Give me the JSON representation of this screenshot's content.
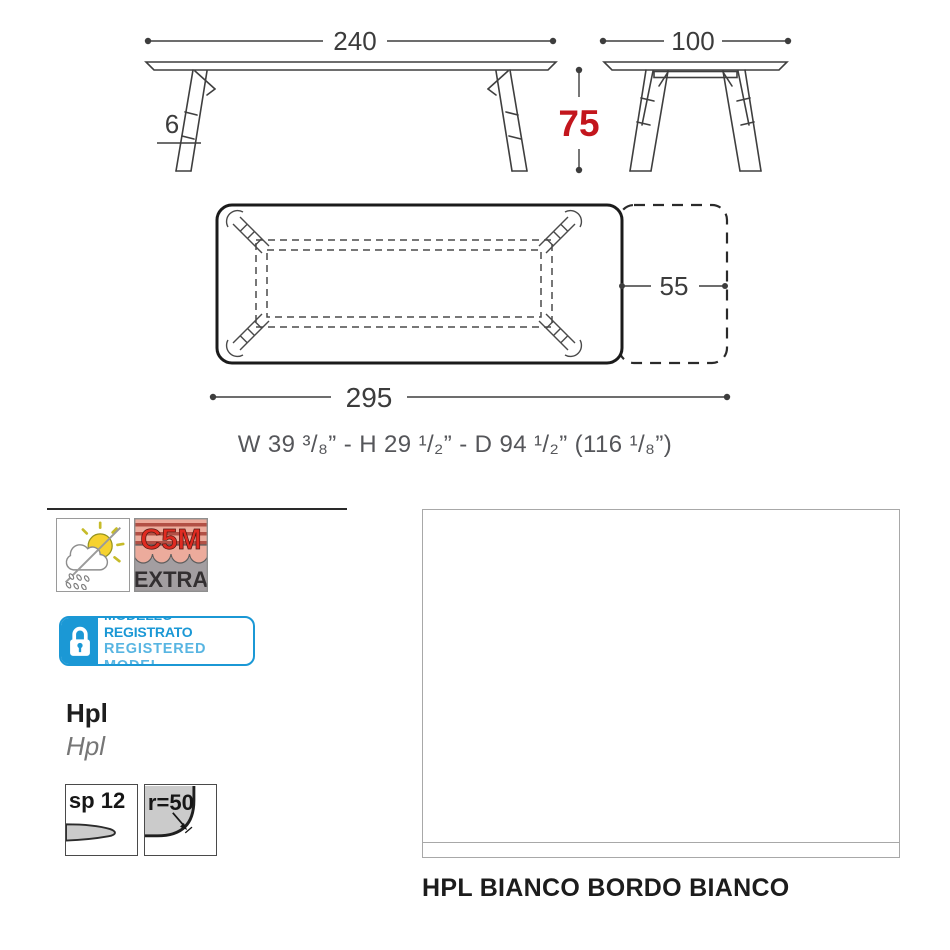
{
  "colors": {
    "accent_red": "#c3161d",
    "badge_blue": "#1b98d5"
  },
  "front_view": {
    "width": "240",
    "height": "75",
    "top_thickness": "6"
  },
  "side_view": {
    "depth": "100"
  },
  "plan_view": {
    "total_length": "295",
    "extension": "55"
  },
  "imperial_line": "W 39 ³/₈” - H 29 ¹/₂”  - D 94 ¹/₂” (116 ¹/₈”)",
  "certifications": {
    "c5m_line1": "C5M",
    "c5m_line2": "EXTRA"
  },
  "registered_badge": {
    "line1": "MODELLO REGISTRATO",
    "line2": "REGISTERED MODEL"
  },
  "material": {
    "title": "Hpl",
    "subtitle": "Hpl"
  },
  "edge_icons": {
    "thickness_label": "sp 12",
    "radius_label": "r=50"
  },
  "finish": {
    "caption": "HPL BIANCO BORDO BIANCO"
  }
}
